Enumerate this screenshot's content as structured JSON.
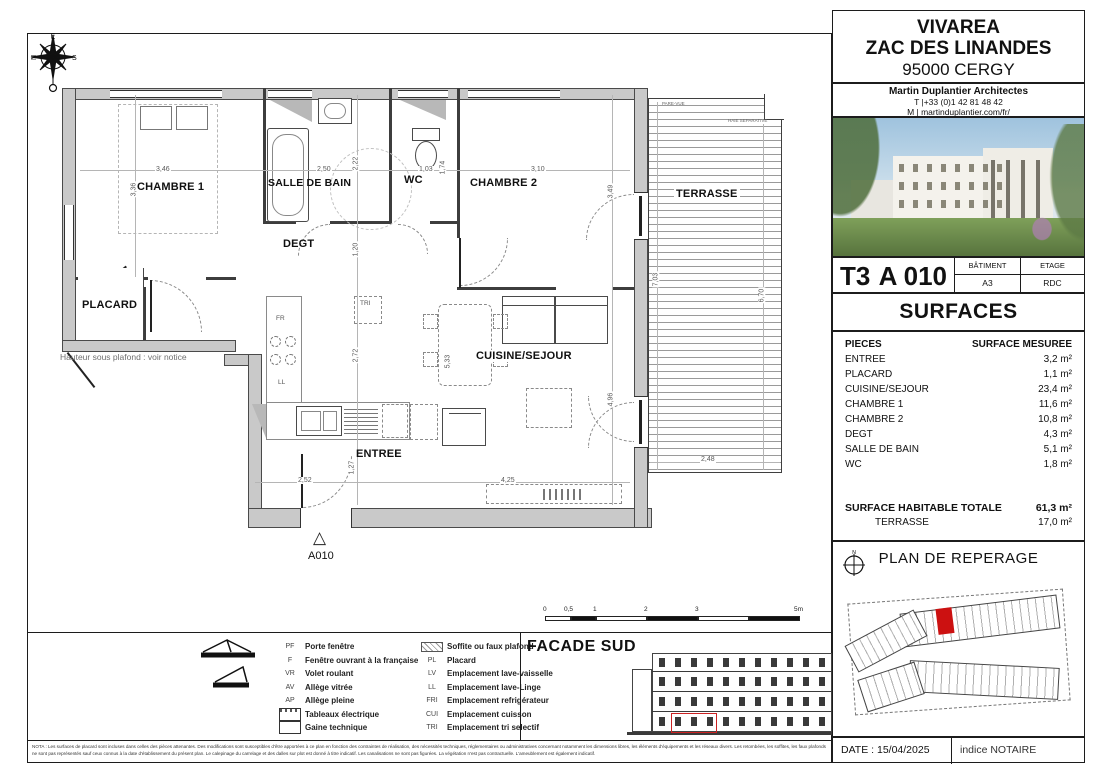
{
  "colors": {
    "accent_red": "#cc1111",
    "wall_gray": "#c9c9c9"
  },
  "header": {
    "project": "VIVAREA",
    "location": "ZAC DES LINANDES",
    "city": "95000 CERGY",
    "architect": "Martin Duplantier Architectes",
    "phone": "T  |+33 (0)1 42 81 48 42",
    "web": "M | martinduplantier.com/fr/"
  },
  "unit": {
    "type": "T3",
    "number": "A 010",
    "batiment_label": "BÂTIMENT",
    "batiment": "A3",
    "etage_label": "ETAGE",
    "etage": "RDC"
  },
  "surfaces": {
    "title": "SURFACES",
    "col_piece": "PIECES",
    "col_surface": "SURFACE MESUREE",
    "rows": [
      {
        "piece": "ENTREE",
        "surface": "3,2 m²"
      },
      {
        "piece": "PLACARD",
        "surface": "1,1 m²"
      },
      {
        "piece": "CUISINE/SEJOUR",
        "surface": "23,4 m²"
      },
      {
        "piece": "CHAMBRE 1",
        "surface": "11,6 m²"
      },
      {
        "piece": "CHAMBRE 2",
        "surface": "10,8 m²"
      },
      {
        "piece": "DEGT",
        "surface": "4,3 m²"
      },
      {
        "piece": "SALLE DE BAIN",
        "surface": "5,1 m²"
      },
      {
        "piece": "WC",
        "surface": "1,8 m²"
      }
    ],
    "total_label": "SURFACE HABITABLE TOTALE",
    "total": "61,3 m²",
    "terrasse_label": "TERRASSE",
    "terrasse": "17,0 m²"
  },
  "reperage": {
    "title": "PLAN DE REPERAGE",
    "north": "N"
  },
  "footer": {
    "date": "DATE : 15/04/2025",
    "indice": "indice NOTAIRE"
  },
  "facade": {
    "title": "FACADE SUD"
  },
  "scalebar": {
    "t0": "0",
    "t05": "0,5",
    "t1": "1",
    "t2": "2",
    "t3": "3",
    "t5": "5m"
  },
  "plan": {
    "rooms": {
      "chambre1": "CHAMBRE 1",
      "sdb": "SALLE DE BAIN",
      "wc": "WC",
      "chambre2": "CHAMBRE 2",
      "terrasse": "TERRASSE",
      "degt": "DEGT",
      "placard": "PLACARD",
      "cuisine": "CUISINE/SEJOUR",
      "entree": "ENTREE"
    },
    "dims": {
      "chambre1_w": "3,46",
      "chambre1_h": "3,36",
      "sdb_w": "2,50",
      "sdb_h": "2,22",
      "wc_w": "1,03",
      "wc_h": "1,74",
      "chambre2_w": "3,10",
      "chambre2_h": "3,49",
      "degt_h": "1,20",
      "cuisine_h": "2,72",
      "table_h": "5,33",
      "sejour_door_h": "4,96",
      "terrasse_h1": "7,03",
      "terrasse_h2": "6,70",
      "terrasse_w": "2,48",
      "entree_w": "2,52",
      "entree_h": "1,27",
      "sejour_w": "4,25"
    },
    "annotations": {
      "pare_vue": "PARE-VUE",
      "haie_separative": "HAIE SEPARATIVE",
      "fr": "FR",
      "ll": "LL",
      "tri": "TRI",
      "note": "Hauteur sous plafond : voir notice",
      "marker": "A010",
      "marker_glyph": "△"
    }
  },
  "legend": {
    "col1": [
      {
        "abbr": "PF",
        "label": "Porte fenêtre"
      },
      {
        "abbr": "F",
        "label": "Fenêtre ouvrant à la française"
      },
      {
        "abbr": "VR",
        "label": "Volet roulant"
      },
      {
        "abbr": "AV",
        "label": "Allège vitrée"
      },
      {
        "abbr": "AP",
        "label": "Allège pleine"
      },
      {
        "abbr": "",
        "label": "Tableaux électrique"
      },
      {
        "abbr": "",
        "label": "Gaine technique"
      }
    ],
    "col2": [
      {
        "abbr": "",
        "label": "Soffite ou faux plafond"
      },
      {
        "abbr": "PL",
        "label": "Placard"
      },
      {
        "abbr": "LV",
        "label": "Emplacement lave-vaisselle"
      },
      {
        "abbr": "LL",
        "label": "Emplacement lave-Linge"
      },
      {
        "abbr": "FRI",
        "label": "Emplacement refrigérateur"
      },
      {
        "abbr": "CUI",
        "label": "Emplacement cuisson"
      },
      {
        "abbr": "TRI",
        "label": "Emplacement tri selectif"
      }
    ]
  },
  "nota": "NOTA : Les surfaces de placard sont incluses dans  celles des pièces attenantes. Des modifications sont susceptibles d'être apportées à ce plan en fonction des contraintes de réalisation, des nécessités techniques,  réglementaires ou administratives concernant notamment les dimensions libres, les éléments d'équipements et les réseaux divers. Les retombées, les soffites, les faux plafonds ne sont pas représentés sauf ceux connus à la date d'établissement du présent plan. Le calepinage du carrelage et des dalles sur plot est donné à titre indicatif.  Les canalisations ne sont pas figurées. La végétation n'est pas contractuelle. L'ameublement est également indicatif."
}
